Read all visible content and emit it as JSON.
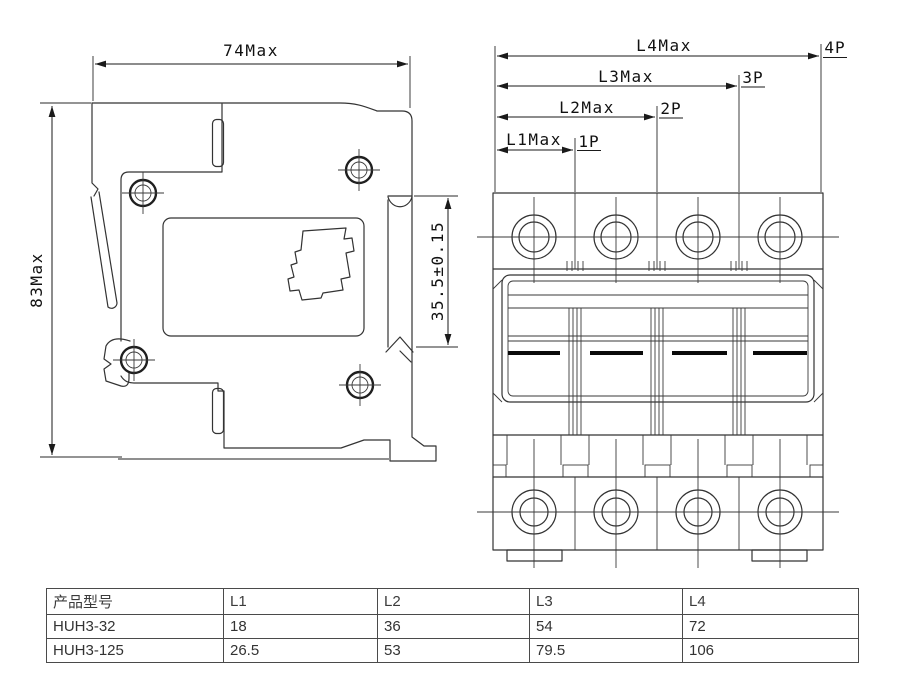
{
  "side_view": {
    "width_dim": "74Max",
    "height_dim": "83Max",
    "rail_dim": "35.5±0.15"
  },
  "front_view": {
    "dims": [
      {
        "length_label": "L1Max",
        "pole_label": "1P"
      },
      {
        "length_label": "L2Max",
        "pole_label": "2P"
      },
      {
        "length_label": "L3Max",
        "pole_label": "3P"
      },
      {
        "length_label": "L4Max",
        "pole_label": "4P"
      }
    ]
  },
  "table": {
    "headers": [
      "产品型号",
      "L1",
      "L2",
      "L3",
      "L4"
    ],
    "rows": [
      [
        "HUH3-32",
        "18",
        "36",
        "54",
        "72"
      ],
      [
        "HUH3-125",
        "26.5",
        "53",
        "79.5",
        "106"
      ]
    ]
  },
  "colors": {
    "line": "#333333",
    "dimension": "#1a1a1a",
    "baseline_gray": "#8f8f8f",
    "table_border": "#4a4a4a",
    "handle_black": "#0a0a0a",
    "background": "#ffffff"
  }
}
